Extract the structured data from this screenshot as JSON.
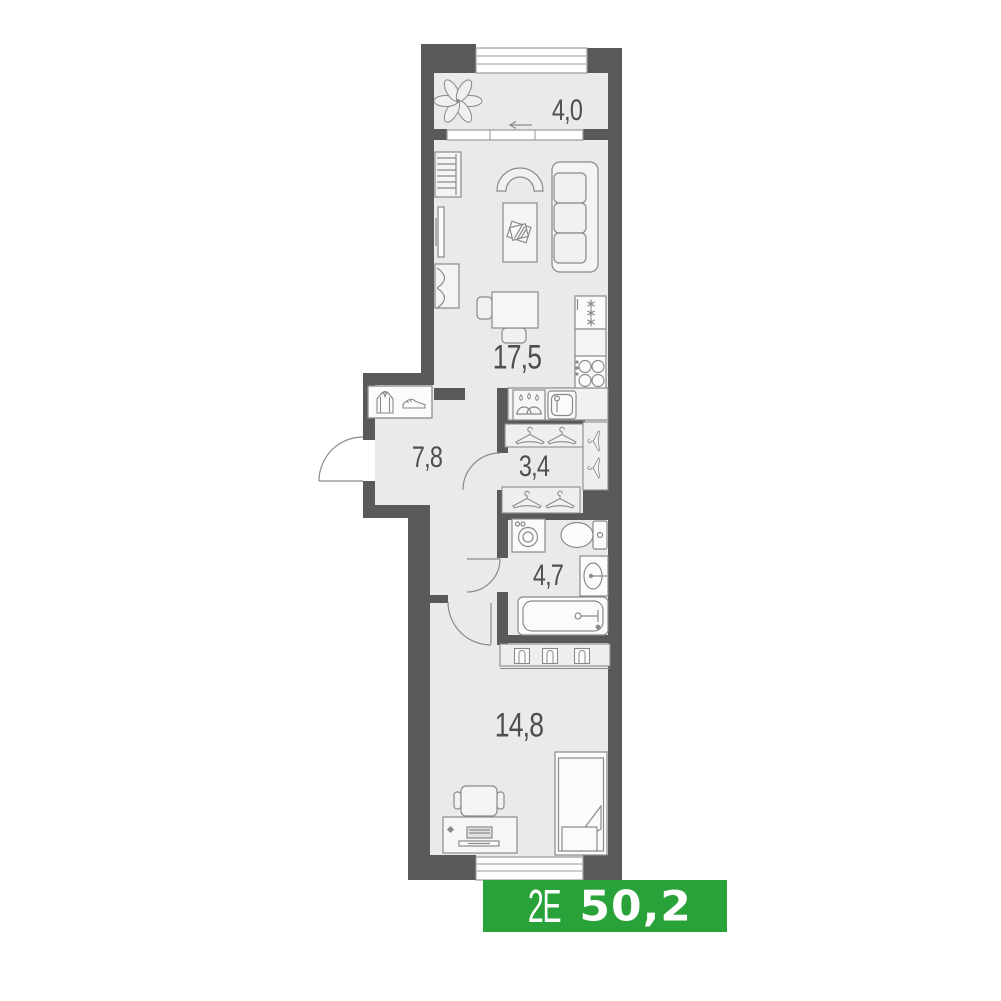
{
  "plan": {
    "rooms": [
      {
        "id": "balcony",
        "area_label": "4,0"
      },
      {
        "id": "living-kitchen",
        "area_label": "17,5"
      },
      {
        "id": "hallway",
        "area_label": "7,8"
      },
      {
        "id": "wardrobe",
        "area_label": "3,4"
      },
      {
        "id": "bathroom",
        "area_label": "4,7"
      },
      {
        "id": "bedroom",
        "area_label": "14,8"
      }
    ],
    "badge": {
      "layout_code": "2Е",
      "total_area": "50,2"
    },
    "colors": {
      "wall": "#595959",
      "floor": "#eaeaea",
      "badge_green": "#2aa23a",
      "line": "#8a8a8a"
    },
    "icons": [
      "plant-icon",
      "bookshelf-icon",
      "tv-icon",
      "cabinet-icon",
      "armchair-icon",
      "coffee-table-icon",
      "sofa-icon",
      "dining-table-icon",
      "fridge-icon",
      "stove-icon",
      "dishwasher-icon",
      "kitchen-sink-icon",
      "coat-rack-icon",
      "jacket-icon",
      "shoe-icon",
      "hanger-icon",
      "washing-machine-icon",
      "toilet-icon",
      "bathroom-sink-icon",
      "bathtub-icon",
      "closet-fold-icon",
      "desk-icon",
      "laptop-icon",
      "desk-chair-icon",
      "bed-icon"
    ]
  }
}
